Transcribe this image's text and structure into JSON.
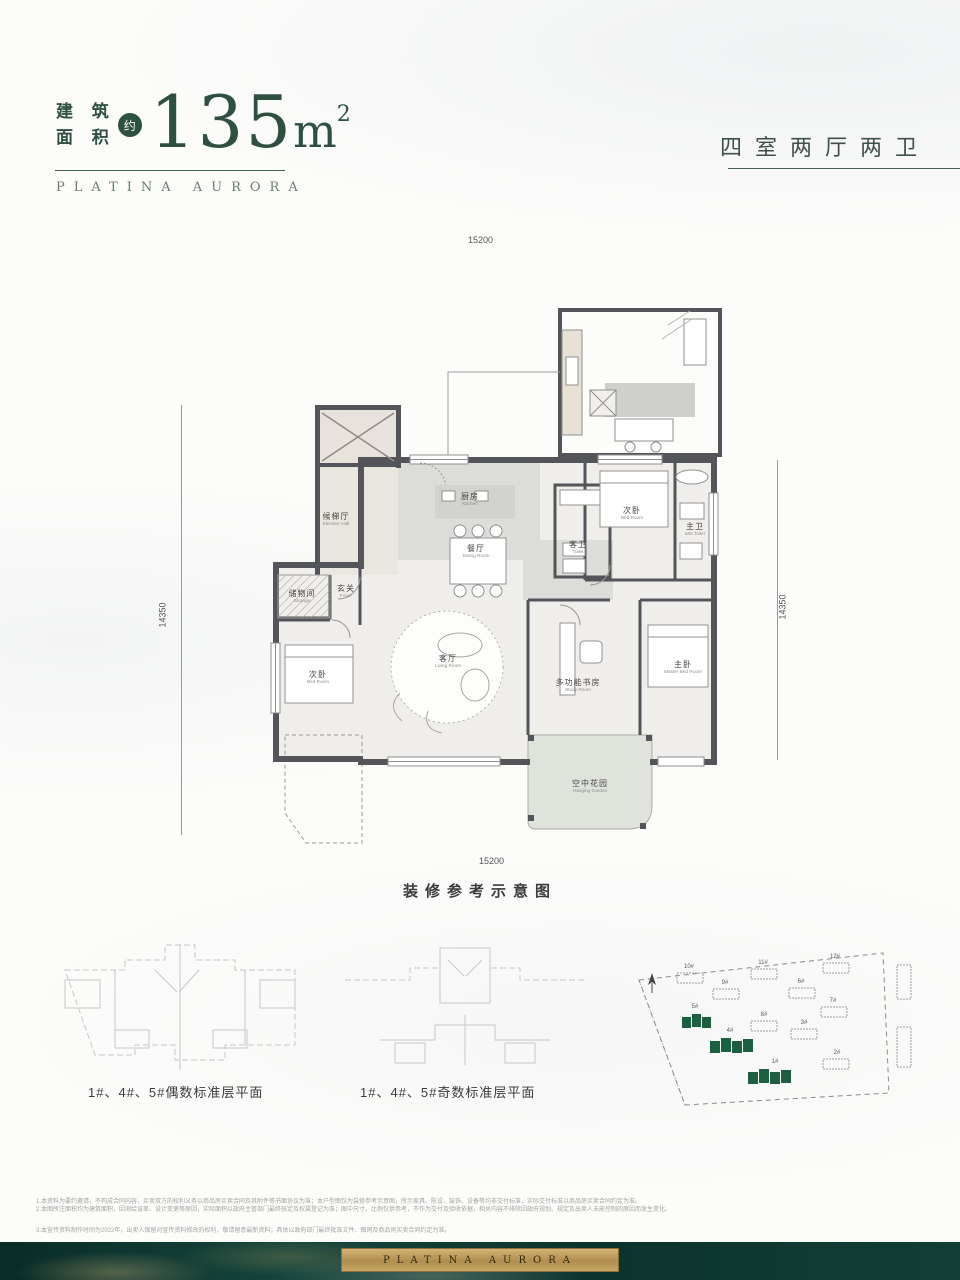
{
  "header": {
    "area_label_line1": "建 筑",
    "area_label_line2": "面 积",
    "approx_badge": "约",
    "area_value": "135",
    "area_unit": "m",
    "area_superscript": "2",
    "brand": "PLATINA AURORA",
    "unit_type": "四室两厅两卫",
    "accent_color": "#2d5040"
  },
  "floor_plan": {
    "dim_top": "15200",
    "dim_bottom": "15200",
    "dim_left": "14350",
    "dim_right": "14350",
    "caption": "装修参考示意图",
    "rooms": {
      "elevator_hall": {
        "zh": "候梯厅",
        "en": "Elevator Hall"
      },
      "kitchen": {
        "zh": "厨房",
        "en": "Kitchen"
      },
      "dining": {
        "zh": "餐厅",
        "en": "Dining Room"
      },
      "guest_bath": {
        "zh": "客卫",
        "en": "Toilet"
      },
      "foyer": {
        "zh": "玄关",
        "en": "Foyer"
      },
      "storage": {
        "zh": "储物间",
        "en": "Storage"
      },
      "bedroom_left": {
        "zh": "次卧",
        "en": "Bed Room"
      },
      "bedroom_top": {
        "zh": "次卧",
        "en": "Bed Room"
      },
      "master_bath": {
        "zh": "主卫",
        "en": "Mst.Toilet"
      },
      "living": {
        "zh": "客厅",
        "en": "Living Room"
      },
      "study": {
        "zh": "多功能书房",
        "en": "Study Room"
      },
      "master_bedroom": {
        "zh": "主卧",
        "en": "Master Bed Room"
      },
      "garden": {
        "zh": "空中花园",
        "en": "Hanging Garden"
      }
    },
    "wall_color": "#54555a",
    "fill_color": "#efeeea"
  },
  "lower": {
    "even_caption": "1#、4#、5#偶数标准层平面",
    "odd_caption": "1#、4#、5#奇数标准层平面"
  },
  "site_plan": {
    "highlight_color": "#1d5f41",
    "buildings": [
      {
        "label": "10#"
      },
      {
        "label": "11#"
      },
      {
        "label": "12#"
      },
      {
        "label": "9#"
      },
      {
        "label": "6#"
      },
      {
        "label": "7#"
      },
      {
        "label": "5#"
      },
      {
        "label": "8#"
      },
      {
        "label": "3#"
      },
      {
        "label": "4#"
      },
      {
        "label": "2#"
      },
      {
        "label": "1#"
      }
    ]
  },
  "disclaimer": {
    "line1": "1.本资料为要约邀请，不构成合同内容，买卖双方的权利义务以商品房买卖合同及其附件等书面协议为准；本户型图仅为装修参考示意图，所示家具、陈设、装饰、设备等均非交付标准，实际交付标准以商品房买卖合同约定为准。",
    "line2": "2.本图所注面积均为建筑面积，因测绘误差、设计变更等原因，实际面积以政府主管部门最终核定及权属登记为准；图中尺寸、比例仅供参考，不作为交付及验收依据，相关内容不排除因政府规划、规定及出卖人未能控制的原因而发生变化。",
    "line3": "3.本宣传资料制作时间为2022年，出卖人保留对宣传资料修改的权利，敬请留意最新资料；具体以政府部门最终批准文件、图则及商品房买卖合同约定为准。"
  },
  "footer": {
    "brand": "PLATINA AURORA",
    "band_color": "#0c332d",
    "plaque_color": "#b99a5b"
  }
}
